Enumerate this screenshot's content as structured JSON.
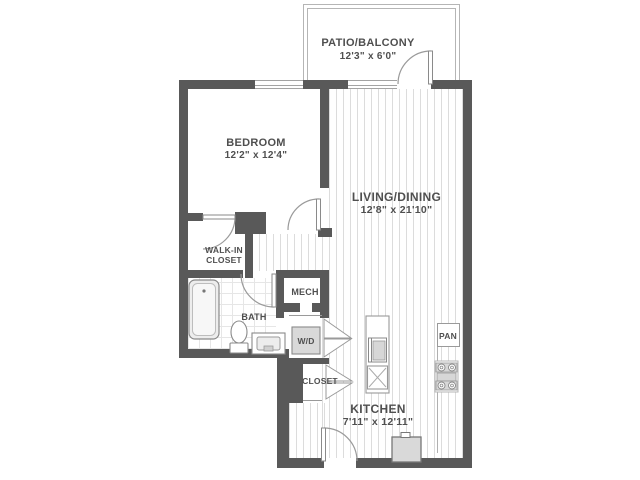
{
  "plan_title": "one-bedroom-apartment-floor-plan",
  "rooms": {
    "patio": {
      "name": "PATIO/BALCONY",
      "dims": "12'3\" x 6'0\""
    },
    "bedroom": {
      "name": "BEDROOM",
      "dims": "12'2\" x 12'4\""
    },
    "living": {
      "name": "LIVING/DINING",
      "dims": "12'8\" x 21'10\""
    },
    "kitchen": {
      "name": "KITCHEN",
      "dims": "7'11\" x 12'11\""
    },
    "walk_in_closet": {
      "name_line1": "WALK-IN",
      "name_line2": "CLOSET"
    },
    "bath": {
      "name": "BATH"
    },
    "mech": {
      "name": "MECH"
    },
    "washer_dryer": {
      "name": "W/D"
    },
    "closet": {
      "name": "CLOSET"
    },
    "pantry": {
      "name": "PAN"
    }
  },
  "colors": {
    "wall": "#595959",
    "floor_stripe": "#dcdcdc",
    "bath_tile": "#e6e6e6",
    "fixture_line": "#9a9a9a",
    "appliance_fill": "#d9d9d9",
    "railing": "#b5b5b5",
    "text": "#4f4f4f",
    "background": "#ffffff"
  }
}
